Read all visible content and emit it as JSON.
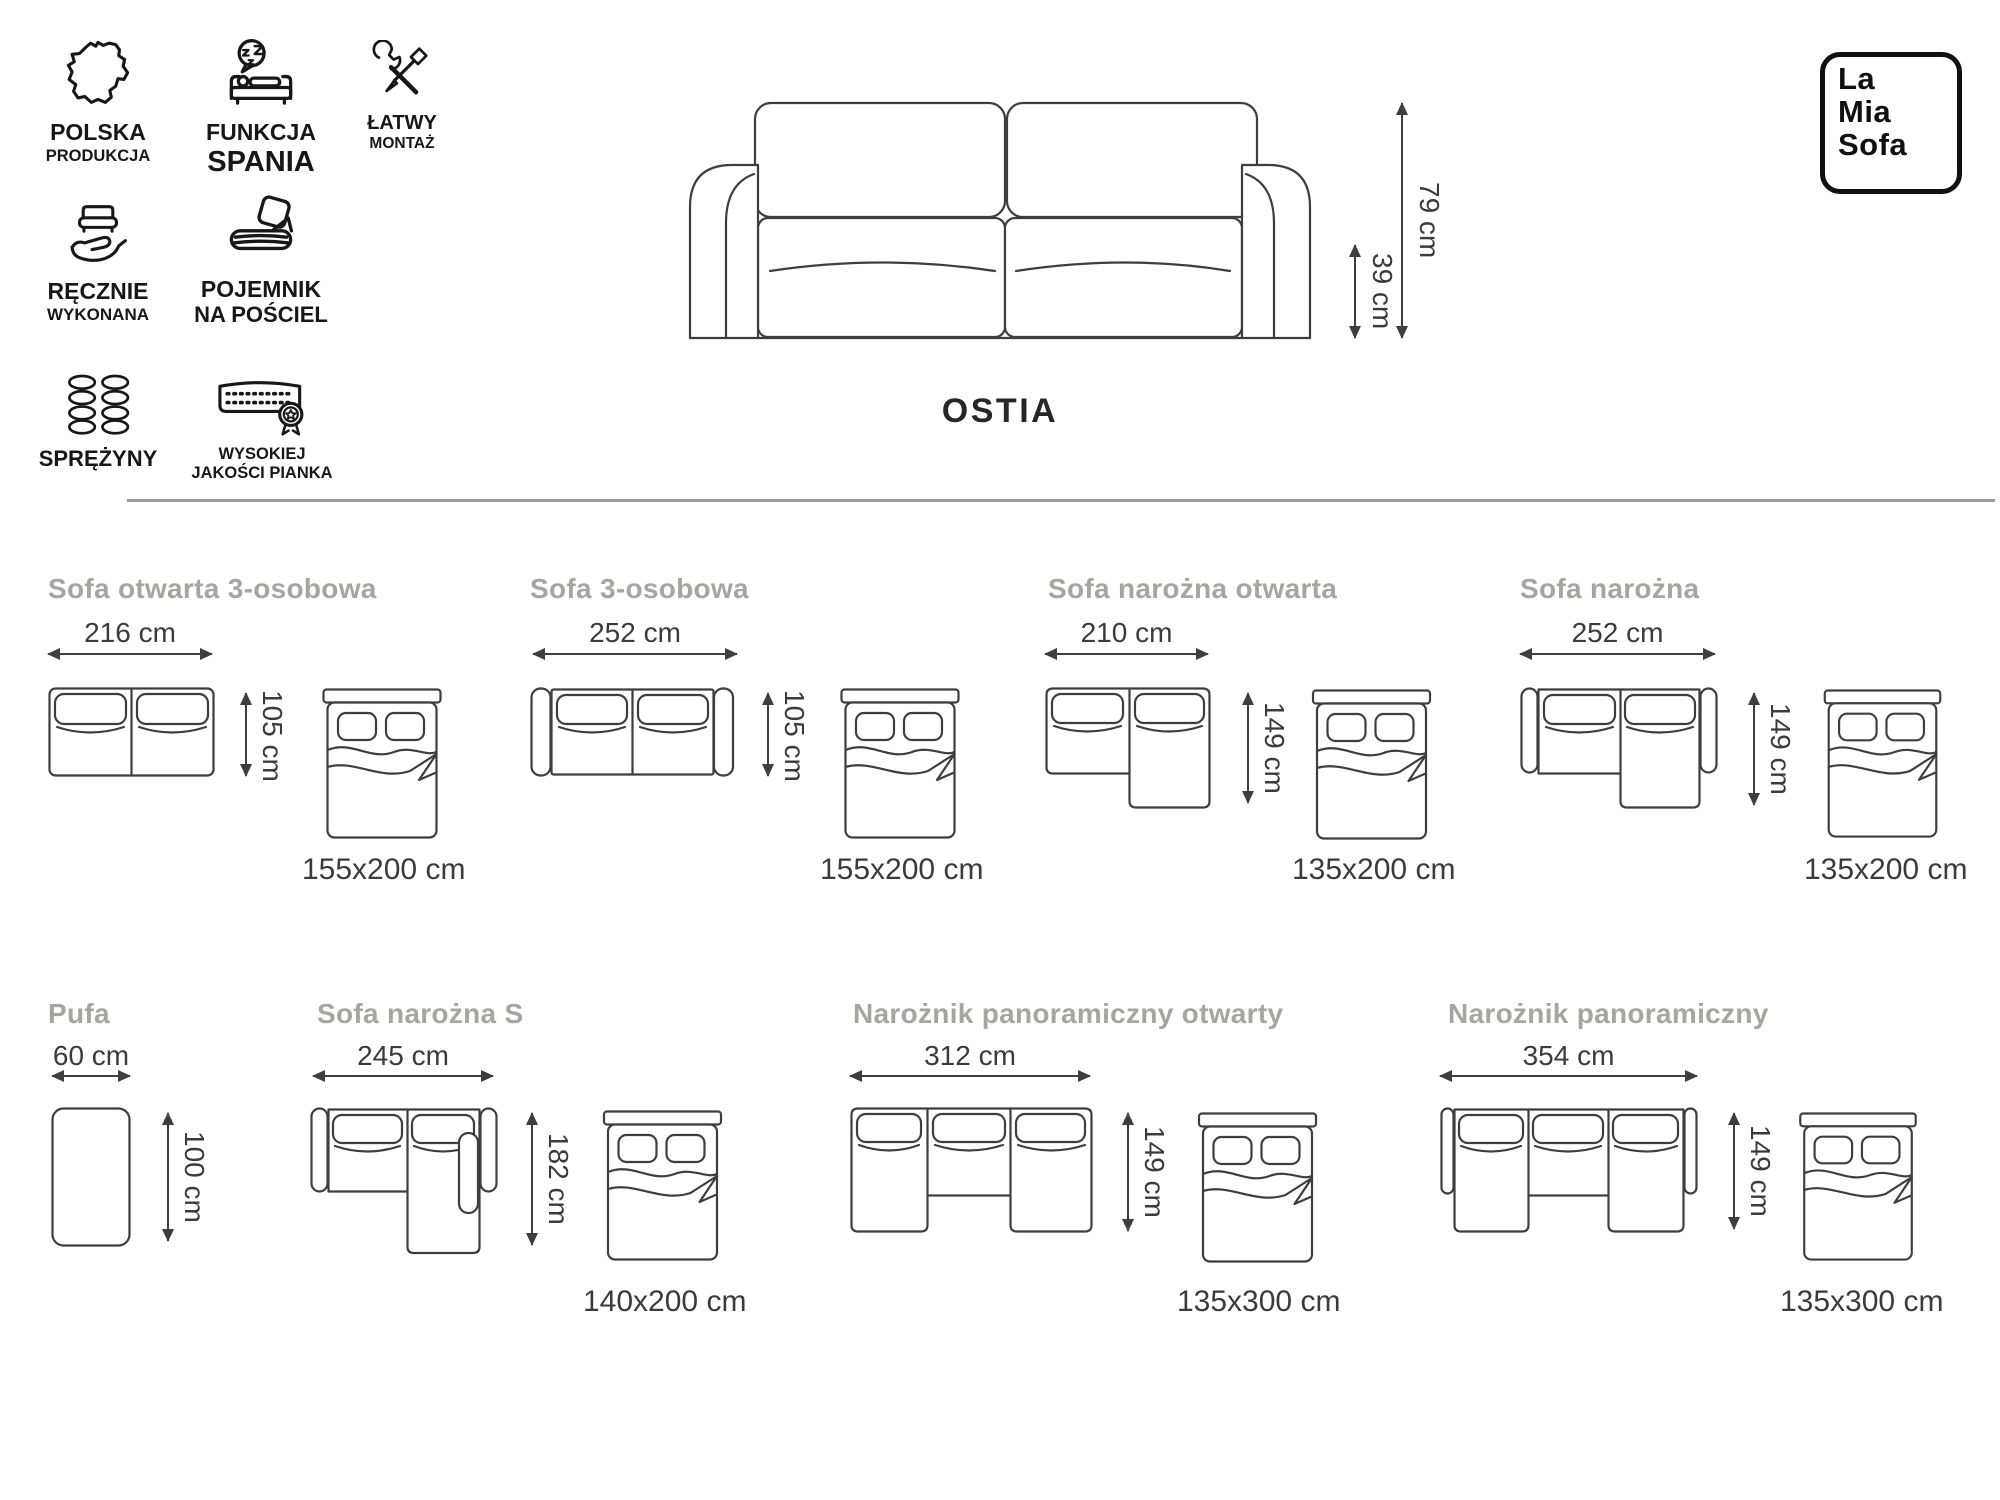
{
  "brand": {
    "line1": "La",
    "line2": "Mia",
    "line3": "Sofa"
  },
  "product": {
    "title": "OSTIA"
  },
  "features": [
    {
      "icon": "poland-map-icon",
      "line1": "POLSKA",
      "line2": "PRODUKCJA"
    },
    {
      "icon": "sleep-function-icon",
      "line1": "FUNKCJA",
      "line2": "SPANIA"
    },
    {
      "icon": "easy-assembly-icon",
      "line1": "ŁATWY",
      "line2": "MONTAŻ"
    },
    {
      "icon": "handmade-icon",
      "line1": "RĘCZNIE",
      "line2": "WYKONANA"
    },
    {
      "icon": "bedding-container-icon",
      "line1": "POJEMNIK",
      "line2": "NA POŚCIEL"
    },
    {
      "icon": "springs-icon",
      "line1": "SPRĘŻYNY",
      "line2": ""
    },
    {
      "icon": "quality-foam-icon",
      "line1": "WYSOKIEJ",
      "line2": "JAKOŚCI PIANKA"
    }
  ],
  "main_sofa": {
    "total_height": "79 cm",
    "seat_height": "39 cm"
  },
  "variants": [
    {
      "name": "Sofa otwarta 3-osobowa",
      "width": "216 cm",
      "depth": "105 cm",
      "bed": "155x200 cm"
    },
    {
      "name": "Sofa 3-osobowa",
      "width": "252 cm",
      "depth": "105 cm",
      "bed": "155x200 cm"
    },
    {
      "name": "Sofa narożna otwarta",
      "width": "210 cm",
      "depth": "149 cm",
      "bed": "135x200 cm"
    },
    {
      "name": "Sofa narożna",
      "width": "252 cm",
      "depth": "149 cm",
      "bed": "135x200 cm"
    },
    {
      "name": "Pufa",
      "width": "60 cm",
      "depth": "100 cm"
    },
    {
      "name": "Sofa narożna S",
      "width": "245 cm",
      "depth": "182 cm",
      "bed": "140x200 cm"
    },
    {
      "name": "Narożnik panoramiczny otwarty",
      "width": "312 cm",
      "depth": "149 cm",
      "bed": "135x300 cm"
    },
    {
      "name": "Narożnik panoramiczny",
      "width": "354 cm",
      "depth": "149 cm",
      "bed": "135x300 cm"
    }
  ],
  "colors": {
    "dimension_text": "#3b3b3b",
    "muted_label": "#a6a59f",
    "line_art": "#3e3e3e",
    "icon": "#171717",
    "divider": "#9a9a9a",
    "background": "#ffffff"
  }
}
